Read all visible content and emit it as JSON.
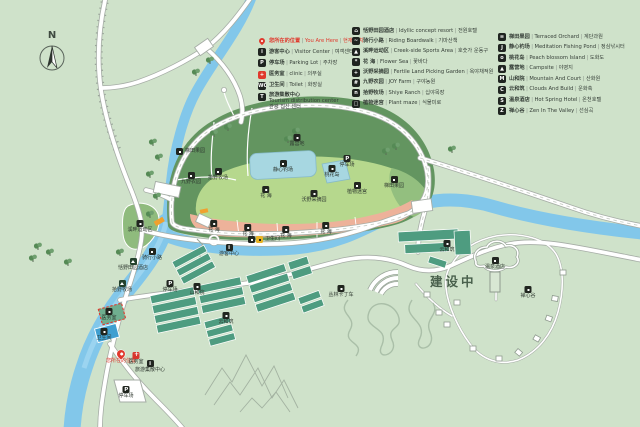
{
  "title": "景区导览图 Scenic Area Guide Map",
  "compass": {
    "label": "N"
  },
  "construction": {
    "label": "建设中"
  },
  "colors": {
    "background": "#cfe2ca",
    "river": "#82c7ea",
    "hill_dark_green": "#639560",
    "hill_light_green": "#b6d88d",
    "flower_band_pink": "#edb29a",
    "pond_blue": "#a7d7e1",
    "road_white": "#ffffff",
    "accent_red": "#e0392d",
    "greenhouse_teal": "#4e9c80",
    "highlight_orange": "#f0a12e"
  },
  "legend": {
    "columns": [
      {
        "items": [
          {
            "icon": "pin",
            "glyph": "",
            "zh": "您所在的位置",
            "en": "You Are Here",
            "kr": "현재 위치",
            "accent": true
          },
          {
            "icon": "visitor-center",
            "glyph": "i",
            "zh": "游客中心",
            "en": "Visitor Center",
            "kr": "여객센터"
          },
          {
            "icon": "parking",
            "glyph": "P",
            "zh": "停车场",
            "en": "Parking Lot",
            "kr": "주차장"
          },
          {
            "icon": "clinic",
            "glyph": "+",
            "zh": "医务室",
            "en": "clinic",
            "kr": "의무실",
            "red_icon": true
          },
          {
            "icon": "toilet",
            "glyph": "WC",
            "zh": "卫生间",
            "en": "Toilet",
            "kr": "화장실"
          },
          {
            "icon": "tourism-center",
            "glyph": "T",
            "zh": "旅游集散中心",
            "en": "Tourism distribution center",
            "kr": "관광 집산 센터",
            "multiline": true
          }
        ]
      },
      {
        "items": [
          {
            "icon": "resort",
            "glyph": "⌂",
            "zh": "恬野田园酒店",
            "en": "Idyllic concept resort",
            "kr": "전원호텔"
          },
          {
            "icon": "riding-boardwalk",
            "glyph": "~",
            "zh": "骑行小路",
            "en": "Riding Boardwalk",
            "kr": "기마산책"
          },
          {
            "icon": "sports-area",
            "glyph": "▲",
            "zh": "溪畔运动区",
            "en": "Creek-side Sports Area",
            "kr": "호숫가 운동구"
          },
          {
            "icon": "flower-sea",
            "glyph": "*",
            "zh": "花 海",
            "en": "Flower Sea",
            "kr": "꽃바다"
          },
          {
            "icon": "picking-garden",
            "glyph": "+",
            "zh": "沃野采摘园",
            "en": "Fertile Land Picking Garden",
            "kr": "옥야채적원"
          },
          {
            "icon": "joy-farm",
            "glyph": "#",
            "zh": "九野农园",
            "en": "JOY Farm",
            "kr": "구야농원"
          },
          {
            "icon": "ranch",
            "glyph": "n",
            "zh": "拾野牧场",
            "en": "Shiye Ranch",
            "kr": "십야목장"
          },
          {
            "icon": "plant-maze",
            "glyph": "□",
            "zh": "植物迷宫",
            "en": "Plant maze",
            "kr": "식물미로"
          }
        ]
      },
      {
        "items": [
          {
            "icon": "terraced-orchard",
            "glyph": "≡",
            "zh": "梯田果园",
            "en": "Terraced Orchard",
            "kr": "계단과원"
          },
          {
            "icon": "fishing-pond",
            "glyph": "J",
            "zh": "静心钓场",
            "en": "Meditation Fishing Pond",
            "kr": "정심낚시터"
          },
          {
            "icon": "peach-island",
            "glyph": "o",
            "zh": "桃花岛",
            "en": "Peach blossom Island",
            "kr": "도화도"
          },
          {
            "icon": "campsite",
            "glyph": "▲",
            "zh": "露营地",
            "en": "Campsite",
            "kr": "야영지"
          },
          {
            "icon": "mountain-court",
            "glyph": "M",
            "zh": "山和院",
            "en": "Mountain And Court",
            "kr": "산화원"
          },
          {
            "icon": "clouds-build",
            "glyph": "C",
            "zh": "云和筑",
            "en": "Clouds And Build",
            "kr": "운화축"
          },
          {
            "icon": "hot-spring",
            "glyph": "S",
            "zh": "温泉酒店",
            "en": "Hot Spring Hotel",
            "kr": "온천호텔"
          },
          {
            "icon": "zen-valley",
            "glyph": "Z",
            "zh": "禅心谷",
            "en": "Zen In The Valley",
            "kr": "선심곡"
          }
        ]
      }
    ]
  },
  "map": {
    "labels": [
      {
        "x": 180,
        "y": 148,
        "zh": "梯田果园",
        "icon": "spot",
        "layout": "right"
      },
      {
        "x": 191,
        "y": 172,
        "zh": "九野农园",
        "icon": "spot"
      },
      {
        "x": 218,
        "y": 168,
        "zh": "拾野牧场",
        "icon": "spot"
      },
      {
        "x": 283,
        "y": 160,
        "zh": "静心钓场",
        "icon": "spot"
      },
      {
        "x": 332,
        "y": 165,
        "zh": "桃花岛",
        "icon": "spot"
      },
      {
        "x": 297,
        "y": 134,
        "zh": "露营地",
        "icon": "spot"
      },
      {
        "x": 266,
        "y": 186,
        "zh": "花 海",
        "icon": "spot"
      },
      {
        "x": 314,
        "y": 190,
        "zh": "沃野采摘园",
        "icon": "spot"
      },
      {
        "x": 357,
        "y": 182,
        "zh": "植物迷宫",
        "icon": "spot"
      },
      {
        "x": 394,
        "y": 176,
        "zh": "梯田果园",
        "icon": "spot"
      },
      {
        "x": 214,
        "y": 220,
        "zh": "花 海",
        "icon": "spot"
      },
      {
        "x": 248,
        "y": 224,
        "zh": "花 海",
        "icon": "spot"
      },
      {
        "x": 286,
        "y": 226,
        "zh": "花 海",
        "icon": "spot"
      },
      {
        "x": 326,
        "y": 222,
        "zh": "花 海",
        "icon": "spot"
      },
      {
        "x": 140,
        "y": 220,
        "zh": "溪畔运动区",
        "icon": "spot"
      },
      {
        "x": 152,
        "y": 248,
        "zh": "骑行小路",
        "icon": "spot"
      },
      {
        "x": 347,
        "y": 155,
        "zh": "停车场",
        "icon": "parking"
      },
      {
        "x": 252,
        "y": 236,
        "zh": "卫生间",
        "icon": "toilet",
        "layout": "right"
      },
      {
        "x": 229,
        "y": 244,
        "zh": "游客中心",
        "icon": "visitor"
      },
      {
        "x": 133,
        "y": 258,
        "zh": "恬野田园酒店",
        "icon": "lodge"
      },
      {
        "x": 122,
        "y": 280,
        "zh": "拾野牧场",
        "icon": "lodge"
      },
      {
        "x": 170,
        "y": 280,
        "zh": "停车场",
        "icon": "parking"
      },
      {
        "x": 197,
        "y": 283,
        "zh": "山和院",
        "icon": "spot"
      },
      {
        "x": 109,
        "y": 308,
        "zh": "医务室",
        "icon": "spot"
      },
      {
        "x": 104,
        "y": 328,
        "zh": "卫生间",
        "icon": "spot"
      },
      {
        "x": 121,
        "y": 350,
        "zh": "您所在的位置",
        "icon": "pin",
        "red": true
      },
      {
        "x": 136,
        "y": 352,
        "zh": "医务室",
        "icon": "clinic"
      },
      {
        "x": 150,
        "y": 360,
        "zh": "旅游集散中心",
        "icon": "visitor"
      },
      {
        "x": 126,
        "y": 386,
        "zh": "停车场",
        "icon": "parking"
      },
      {
        "x": 226,
        "y": 312,
        "zh": "云和筑",
        "icon": "spot"
      },
      {
        "x": 447,
        "y": 240,
        "zh": "云和筑",
        "icon": "spot"
      },
      {
        "x": 495,
        "y": 257,
        "zh": "温泉酒店",
        "icon": "spot"
      },
      {
        "x": 528,
        "y": 286,
        "zh": "禅心谷",
        "icon": "spot"
      },
      {
        "x": 341,
        "y": 285,
        "zh": "丛林卡丁车",
        "icon": "spot"
      }
    ],
    "construction_pos": {
      "x": 430,
      "y": 271
    },
    "compass_pos": {
      "x": 52,
      "y": 30
    }
  }
}
